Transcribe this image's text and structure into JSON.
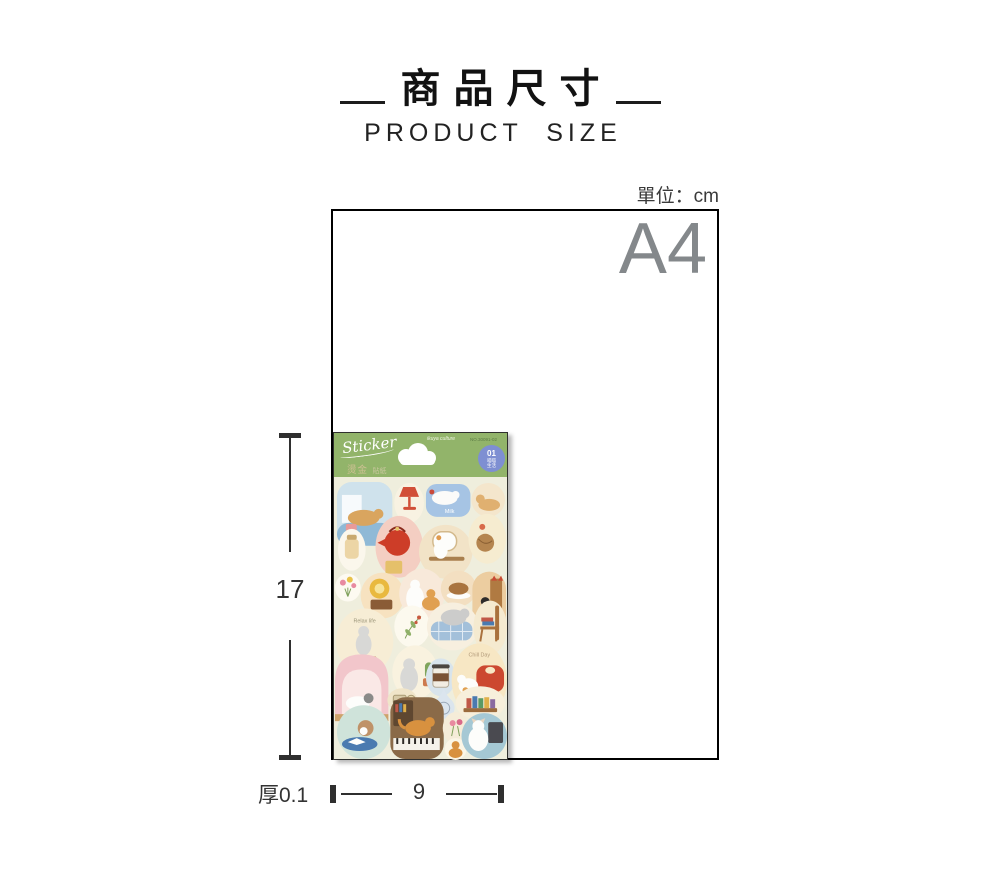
{
  "title_block": {
    "title": "商品尺寸",
    "subtitle": "PRODUCT SIZE"
  },
  "unit_label": "單位：cm",
  "paper": {
    "size_label": "A4"
  },
  "dimensions": {
    "height_cm": "17",
    "width_cm": "9",
    "thickness_label": "厚0.1"
  },
  "sticker_sheet": {
    "header": {
      "script_label": "Sticker",
      "foil_main": "燙金",
      "foil_sub": "貼紙",
      "brand_name": "ikuya culture",
      "product_code": "NO.30091-02",
      "badge": {
        "number": "01",
        "line1": "喵喵",
        "line2": "生活"
      }
    },
    "labels": {
      "milk": "Milk",
      "relax": "Relax life",
      "chill": "Chill Day"
    },
    "colors": {
      "header_green": "#92b46a",
      "badge_blue": "#7e8fd2",
      "body_cream": "#efeedd"
    }
  }
}
